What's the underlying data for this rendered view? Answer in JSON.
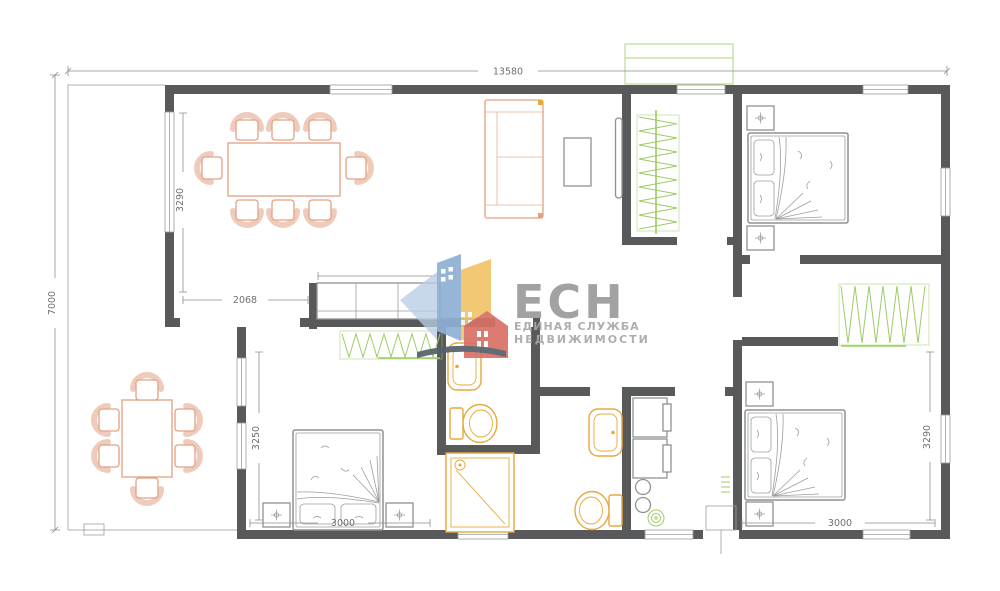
{
  "watermark": {
    "brand": "ЕСН",
    "tagline1": "ЕДИНАЯ СЛУЖБА",
    "tagline2": "НЕДВИЖИМОСТИ"
  },
  "dimensions": {
    "total_width": "13580",
    "total_height": "7000",
    "dining_room_depth": "3290",
    "dining_opening_width": "2068",
    "bedroom_left_depth": "3250",
    "bedroom_left_width": "3000",
    "bedroom_right_depth": "3290",
    "bedroom_right_width": "3000"
  },
  "colors": {
    "wall": "#58595b",
    "furniture_accent": "#e2a184",
    "fixture_accent": "#e5a93e",
    "wardrobe_green": "#9ccc65",
    "sketch_gray": "#8f9193",
    "dimension_text": "#6f6f6f",
    "logo_text": "#9b9b9b",
    "logo_blue": "#8fb0d4",
    "logo_yellow": "#f2c46a",
    "logo_red": "#d97066"
  }
}
